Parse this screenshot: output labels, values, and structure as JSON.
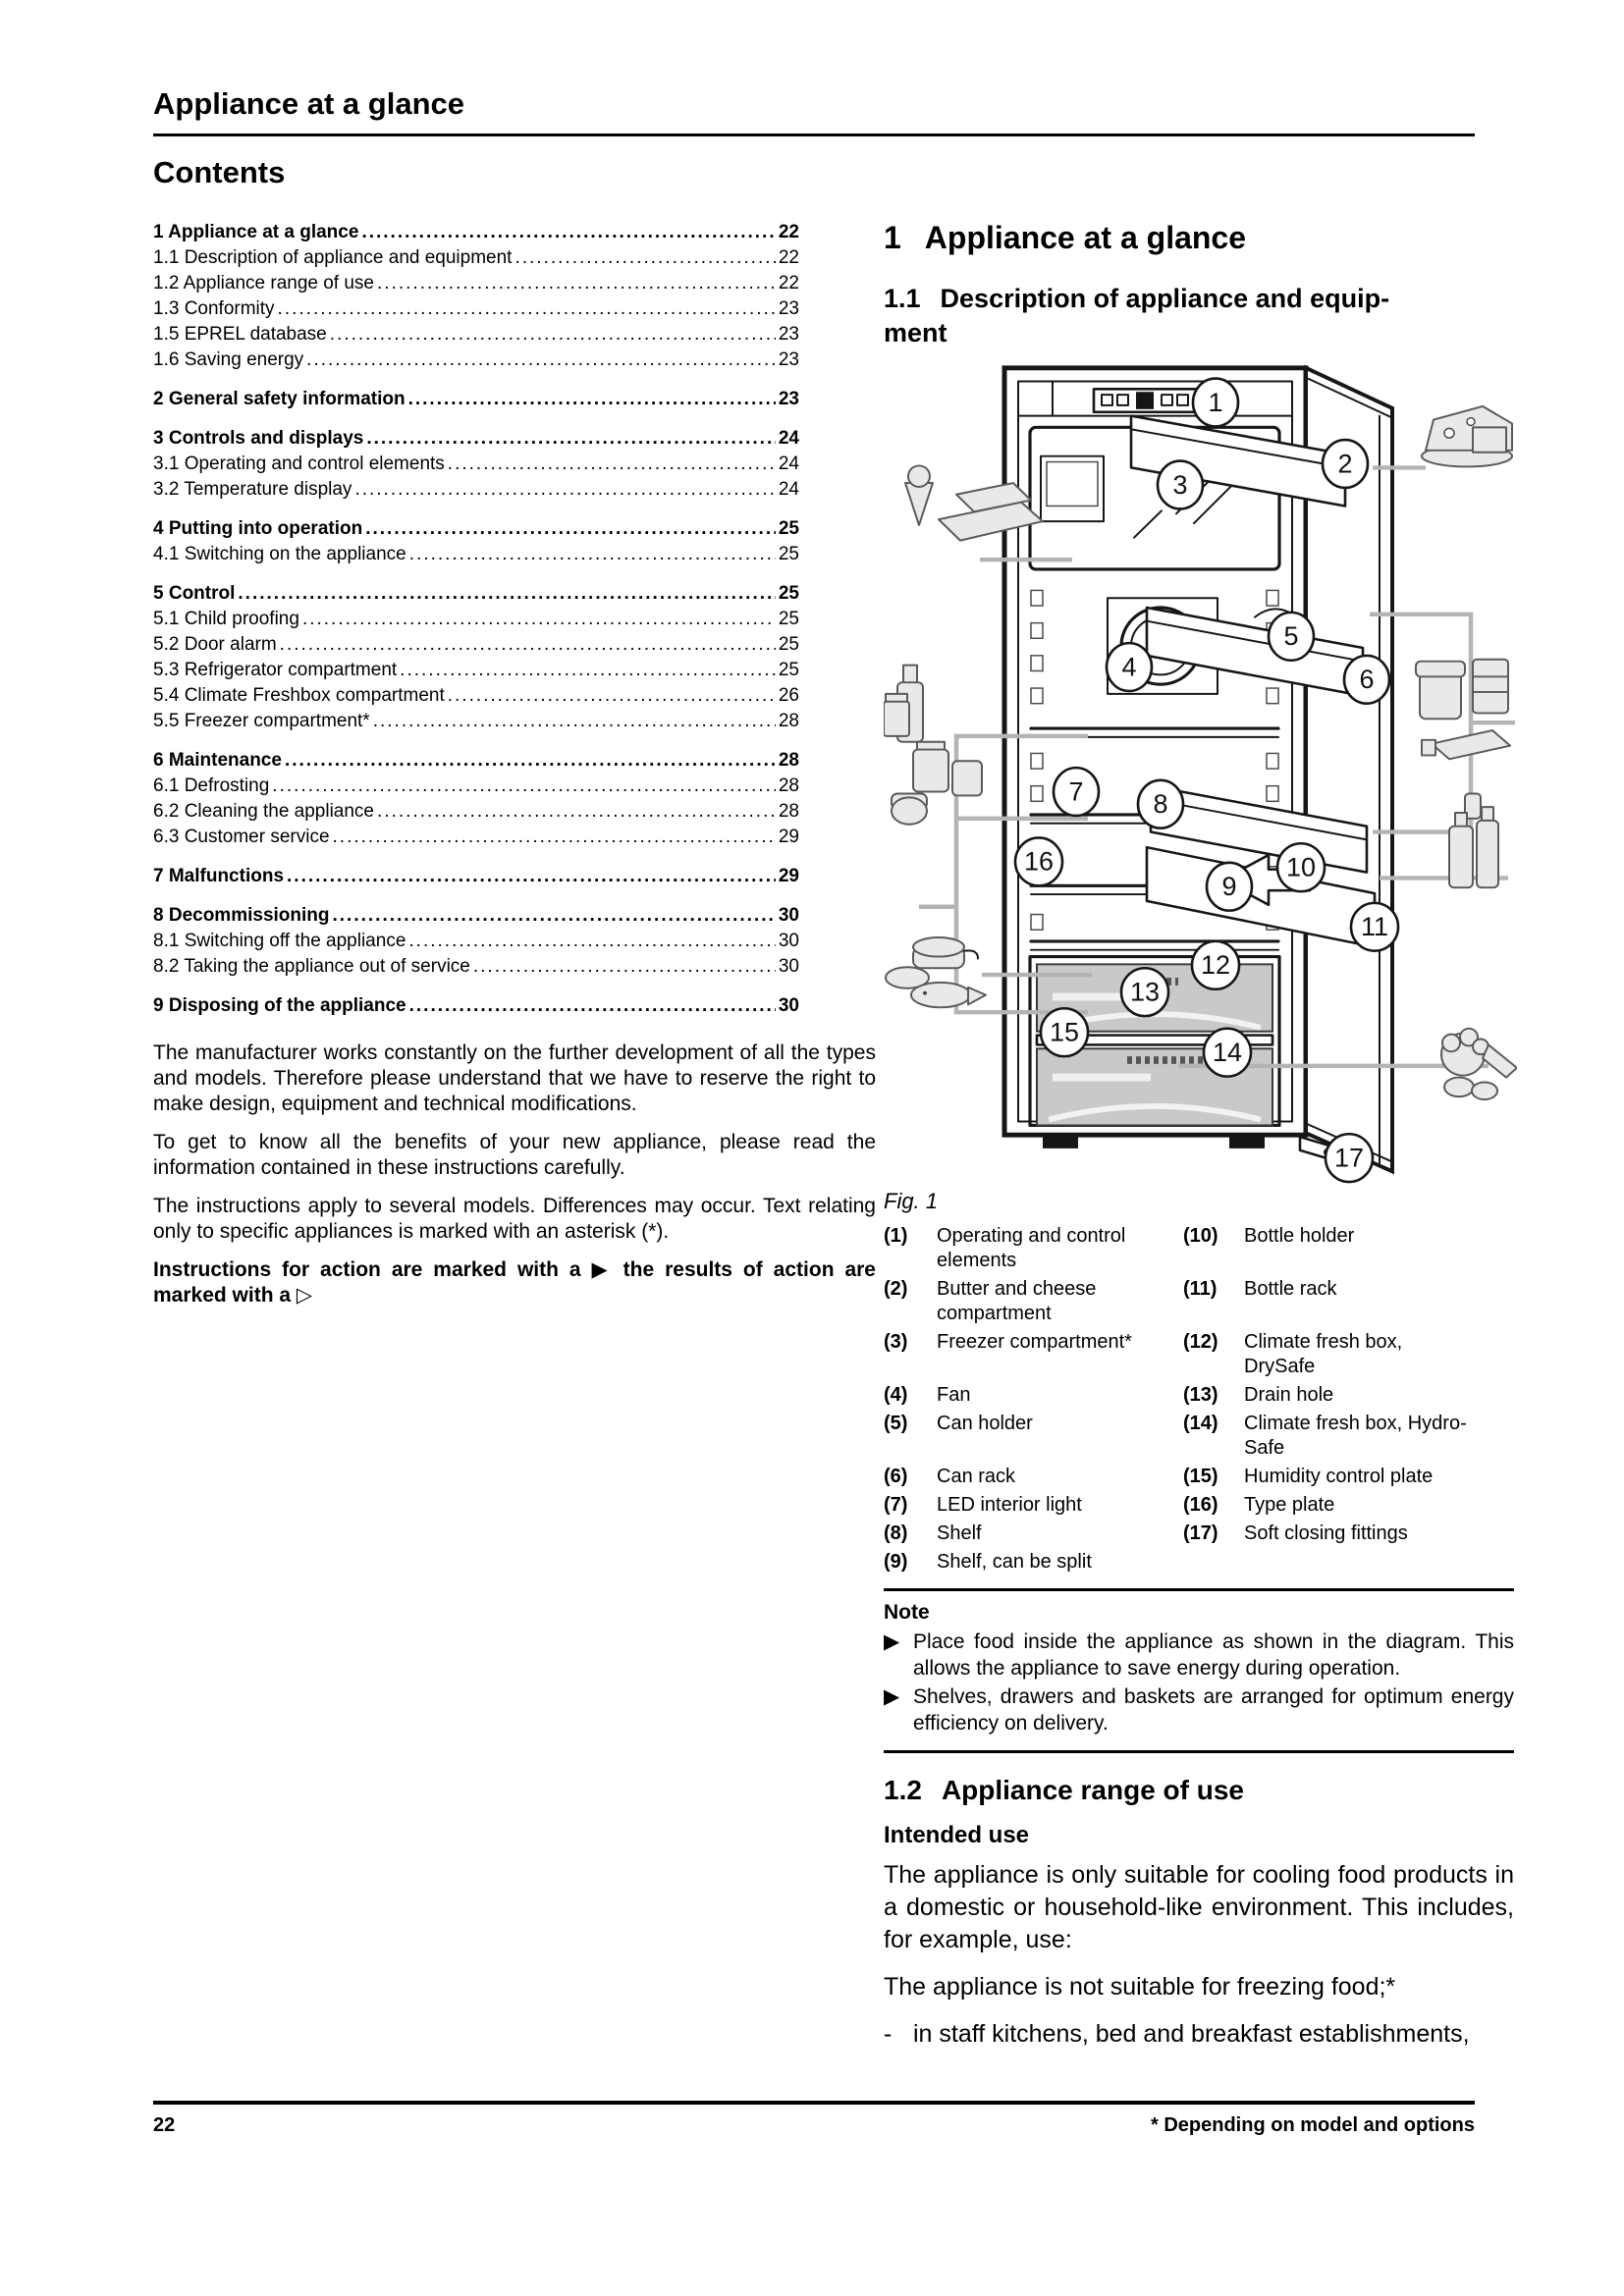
{
  "page": {
    "title": "Appliance at a glance",
    "footer_page": "22",
    "footer_note": "* Depending on model and options"
  },
  "contents": {
    "title": "Contents",
    "items": [
      {
        "label": "1 Appliance at a glance",
        "page": "22"
      },
      {
        "label": "1.1 Description of appliance and equipment",
        "page": "22"
      },
      {
        "label": "1.2 Appliance range of use",
        "page": "22"
      },
      {
        "label": "1.3 Conformity",
        "page": "23"
      },
      {
        "label": "1.5 EPREL database",
        "page": "23"
      },
      {
        "label": "1.6 Saving energy",
        "page": "23"
      },
      {
        "label": "2 General safety information",
        "page": "23"
      },
      {
        "label": "3 Controls and displays",
        "page": "24"
      },
      {
        "label": "3.1 Operating and control elements",
        "page": "24"
      },
      {
        "label": "3.2 Temperature display",
        "page": "24"
      },
      {
        "label": "4 Putting into operation",
        "page": "25"
      },
      {
        "label": "4.1 Switching on the appliance",
        "page": "25"
      },
      {
        "label": "5 Control",
        "page": "25"
      },
      {
        "label": "5.1 Child proofing",
        "page": "25"
      },
      {
        "label": "5.2 Door alarm",
        "page": "25"
      },
      {
        "label": "5.3 Refrigerator compartment",
        "page": "25"
      },
      {
        "label": "5.4 Climate Freshbox compartment",
        "page": "26"
      },
      {
        "label": "5.5 Freezer compartment*",
        "page": "28"
      },
      {
        "label": "6 Maintenance",
        "page": "28"
      },
      {
        "label": "6.1 Defrosting",
        "page": "28"
      },
      {
        "label": "6.2 Cleaning the appliance",
        "page": "28"
      },
      {
        "label": "6.3 Customer service",
        "page": "29"
      },
      {
        "label": "7 Malfunctions",
        "page": "29"
      },
      {
        "label": "8 Decommissioning",
        "page": "30"
      },
      {
        "label": "8.1 Switching off the appliance",
        "page": "30"
      },
      {
        "label": "8.2 Taking the appliance out of service",
        "page": "30"
      },
      {
        "label": "9 Disposing of the appliance",
        "page": "30"
      }
    ]
  },
  "intro": {
    "p1": "The manufacturer works constantly on the further development of all the types and models. Therefore please understand that we have to reserve the right to make design, equipment and technical modifications.",
    "p2": "To get to know all the benefits of your new appliance, please read the information contained in these instructions carefully.",
    "p3": "The instructions apply to several models. Differences may occur. Text relating only to specific appliances is marked with an asterisk (*).",
    "p4": "Instructions for action are marked with a ▶ the results of action are marked with a ▷"
  },
  "section1": {
    "num": "1",
    "title": "Appliance at a glance"
  },
  "section11": {
    "num": "1.1",
    "title": "Description of appliance and equip-\nment"
  },
  "figure": {
    "caption": "Fig. 1",
    "callouts": [
      "1",
      "2",
      "3",
      "4",
      "5",
      "6",
      "7",
      "8",
      "9",
      "10",
      "11",
      "12",
      "13",
      "14",
      "15",
      "16",
      "17"
    ]
  },
  "legend": {
    "left": [
      {
        "num": "(1)",
        "text": "Operating and control\nelements"
      },
      {
        "num": "(2)",
        "text": "Butter and cheese\ncompartment"
      },
      {
        "num": "(3)",
        "text": "Freezer compartment*"
      },
      {
        "num": "(4)",
        "text": "Fan"
      },
      {
        "num": "(5)",
        "text": "Can holder"
      },
      {
        "num": "(6)",
        "text": "Can rack"
      },
      {
        "num": "(7)",
        "text": "LED interior light"
      },
      {
        "num": "(8)",
        "text": "Shelf"
      },
      {
        "num": "(9)",
        "text": "Shelf, can be split"
      }
    ],
    "right": [
      {
        "num": "(10)",
        "text": "Bottle holder"
      },
      {
        "num": "(11)",
        "text": "Bottle rack"
      },
      {
        "num": "(12)",
        "text": "Climate fresh box,\nDrySafe"
      },
      {
        "num": "(13)",
        "text": "Drain hole"
      },
      {
        "num": "(14)",
        "text": "Climate fresh box, Hydro-\nSafe"
      },
      {
        "num": "(15)",
        "text": "Humidity control plate"
      },
      {
        "num": "(16)",
        "text": "Type plate"
      },
      {
        "num": "(17)",
        "text": "Soft closing fittings"
      }
    ]
  },
  "note": {
    "title": "Note",
    "marker": "▶",
    "items": [
      "Place food inside the appliance as shown in the diagram. This allows the appliance to save energy during operation.",
      "Shelves, drawers and baskets are arranged for optimum energy efficiency on delivery."
    ]
  },
  "section12": {
    "num": "1.2",
    "title": "Appliance range of use",
    "intended_title": "Intended use",
    "p1": "The appliance is only suitable for cooling food products in a domestic or household-like envi­ronment. This includes, for example, use:",
    "p2": "The appliance is not suitable for freezing food;*",
    "list_marker": "-",
    "list_item": "in staff kitchens, bed and breakfast establish­ments,"
  }
}
